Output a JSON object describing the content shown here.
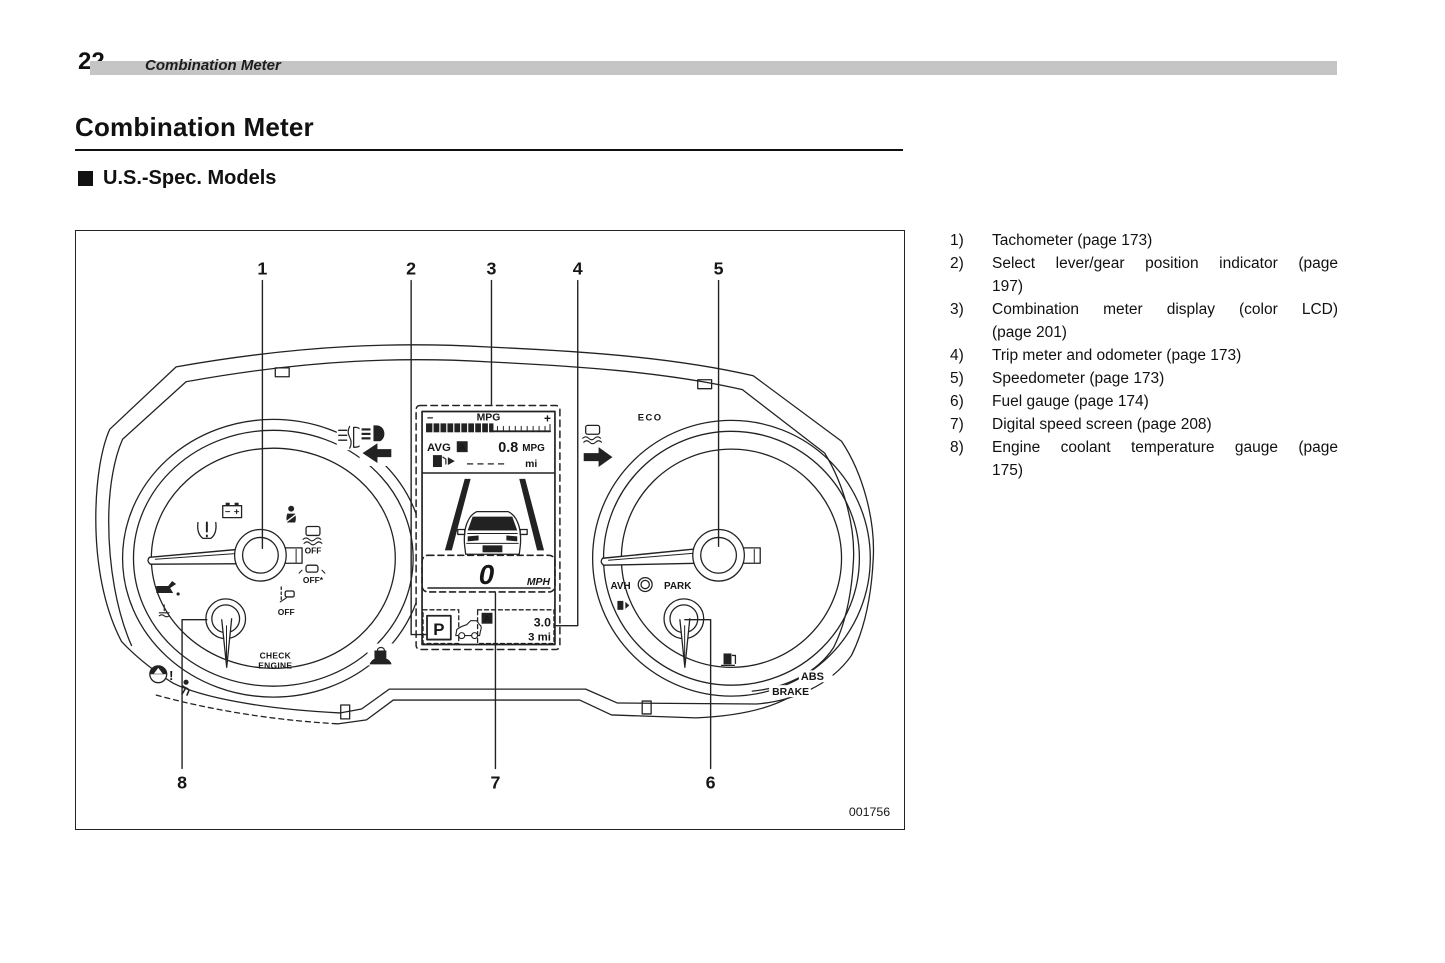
{
  "page": {
    "number": "22",
    "running_header": "Combination Meter"
  },
  "title": "Combination Meter",
  "section": {
    "heading": "U.S.-Spec. Models"
  },
  "legend": {
    "items": [
      {
        "num": "1)",
        "line1": "Tachometer (page 173)"
      },
      {
        "num": "2)",
        "line1": "Select lever/gear position indicator (page",
        "line2": "197)"
      },
      {
        "num": "3)",
        "line1": "Combination meter display (color LCD)",
        "line2": "(page 201)"
      },
      {
        "num": "4)",
        "line1": "Trip meter and odometer (page 173)"
      },
      {
        "num": "5)",
        "line1": "Speedometer (page 173)"
      },
      {
        "num": "6)",
        "line1": "Fuel gauge (page 174)"
      },
      {
        "num": "7)",
        "line1": "Digital speed screen (page 208)"
      },
      {
        "num": "8)",
        "line1": "Engine coolant temperature gauge (page",
        "line2": "175)"
      }
    ]
  },
  "figure": {
    "code": "001756",
    "callouts": {
      "c1": "1",
      "c2": "2",
      "c3": "3",
      "c4": "4",
      "c5": "5",
      "c6": "6",
      "c7": "7",
      "c8": "8"
    },
    "lcd": {
      "minus": "−",
      "mpg_label": "MPG",
      "plus": "+",
      "avg_label": "AVG",
      "avg_badge": "A",
      "avg_value": "0.8",
      "avg_unit": "MPG",
      "range_value": "– – – –",
      "range_unit": "mi",
      "speed_value": "0",
      "speed_unit": "MPH",
      "gear": "P",
      "trip_badge": "A",
      "trip_value": "3.0",
      "odo_value": "3 mi"
    },
    "labels": {
      "check1": "CHECK",
      "check2": "ENGINE",
      "vdc_off": "OFF",
      "off_star": "OFF*",
      "lane_off": "OFF",
      "warn_excl": "!",
      "avh": "AVH",
      "park": "PARK",
      "eco": "ECO",
      "abs": "ABS",
      "brake": "BRAKE"
    }
  }
}
